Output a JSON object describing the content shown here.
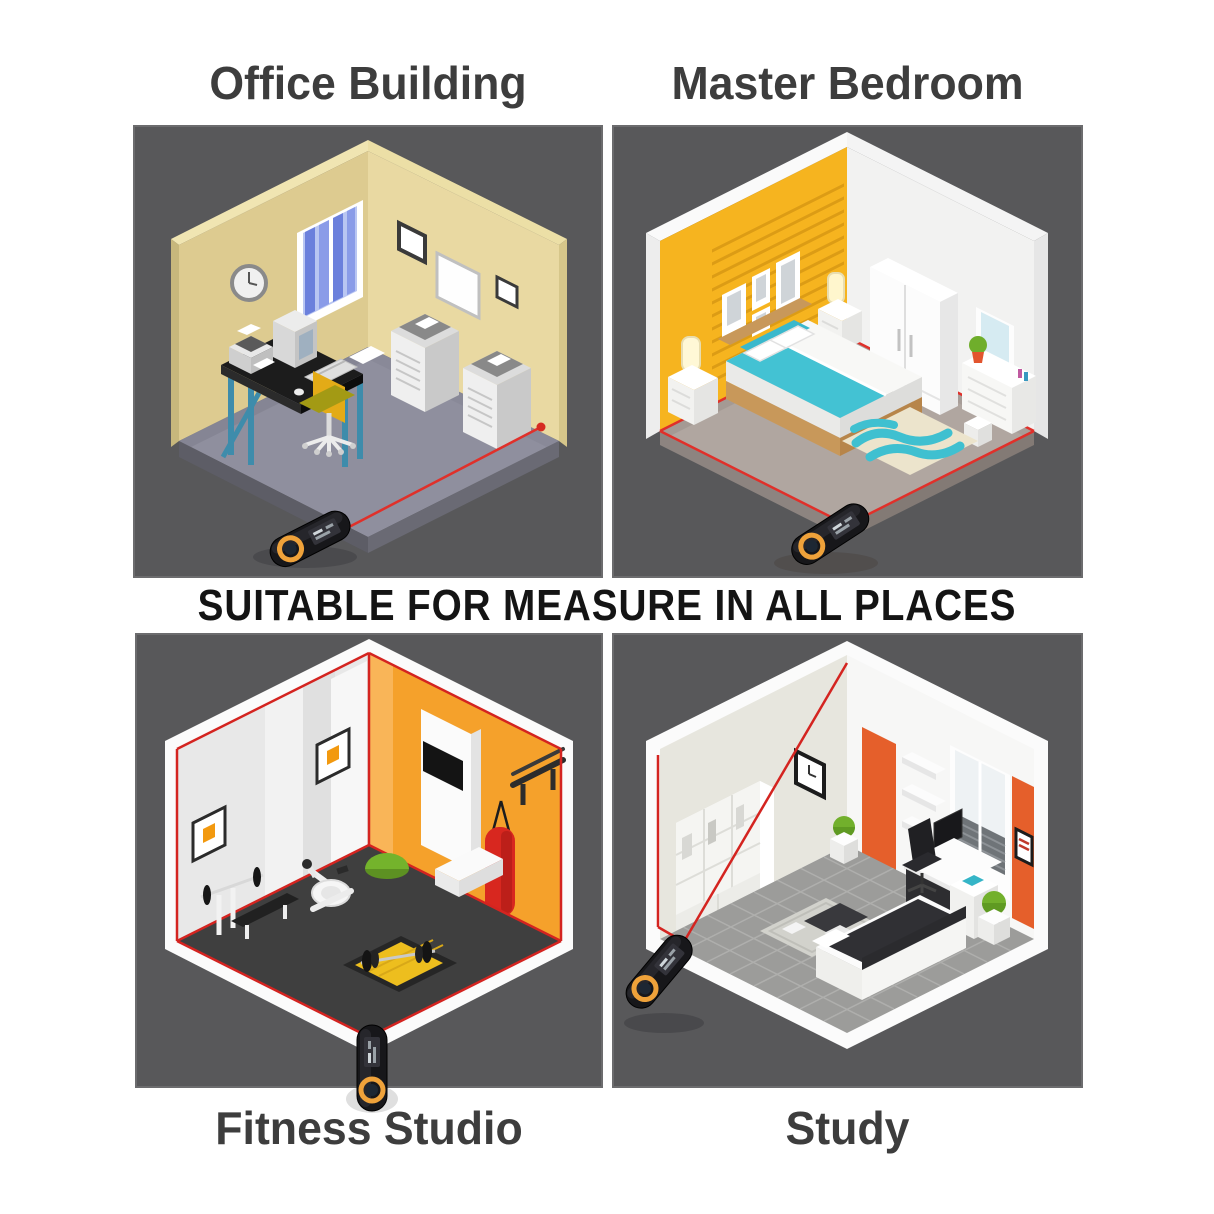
{
  "page": {
    "background": "#ffffff",
    "panel_background": "#58585a",
    "title_color": "#3d3d3d"
  },
  "banner": {
    "text": "SUITABLE FOR MEASURE IN ALL PLACES",
    "color": "#141414"
  },
  "panels": [
    {
      "id": "office-building",
      "label": "Office Building",
      "scene": "isometric office with desk, computer, office chair, two copiers; laser beam to red dot on wall",
      "wall_color": "#ddcb90",
      "floor_color": "#8f8f9e"
    },
    {
      "id": "master-bedroom",
      "label": "Master Bedroom",
      "scene": "isometric bedroom with double bed, nightstands, lamps, wardrobe, vanity, wavy rug; laser traces floor perimeter",
      "wall_color": "#f6b41f",
      "floor_color": "#b0a6a0"
    },
    {
      "id": "fitness-studio",
      "label": "Fitness Studio",
      "scene": "isometric gym with bench, barbells, exercise bike, bosu ball, punching bag; laser wireframe of room volume",
      "wall_color": "#f5a12b",
      "floor_color": "#3f3f3f"
    },
    {
      "id": "study",
      "label": "Study",
      "scene": "isometric study with bookshelf, clock, shelves, window, desk, sofa, plants; laser measuring wall diagonal",
      "wall_color": "#e55f2b",
      "floor_color": "#9c9c9a"
    }
  ],
  "device": {
    "name": "laser distance measurer",
    "body_color": "#17171a",
    "ring_color": "#efa23a",
    "laser_color": "#e0302a"
  }
}
